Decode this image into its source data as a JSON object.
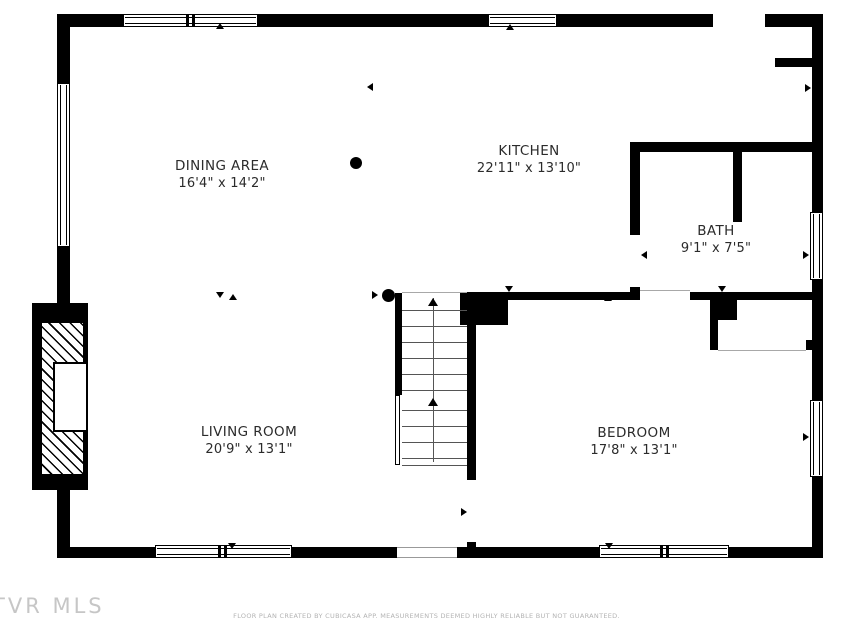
{
  "rooms": [
    {
      "name": "DINING AREA",
      "dims": "16'4\" x 14'2\""
    },
    {
      "name": "KITCHEN",
      "dims": "22'11\" x 13'10\""
    },
    {
      "name": "BATH",
      "dims": "9'1\" x 7'5\""
    },
    {
      "name": "LIVING ROOM",
      "dims": "20'9\" x 13'1\""
    },
    {
      "name": "BEDROOM",
      "dims": "17'8\" x 13'1\""
    }
  ],
  "watermark": "TVR MLS",
  "footer": "FLOOR PLAN CREATED BY CUBICASA APP. MEASUREMENTS DEEMED HIGHLY RELIABLE BUT NOT GUARANTEED.",
  "colors": {
    "wall": "#000000",
    "label": "#2b2b2b",
    "muted": "#b3b3b3"
  }
}
